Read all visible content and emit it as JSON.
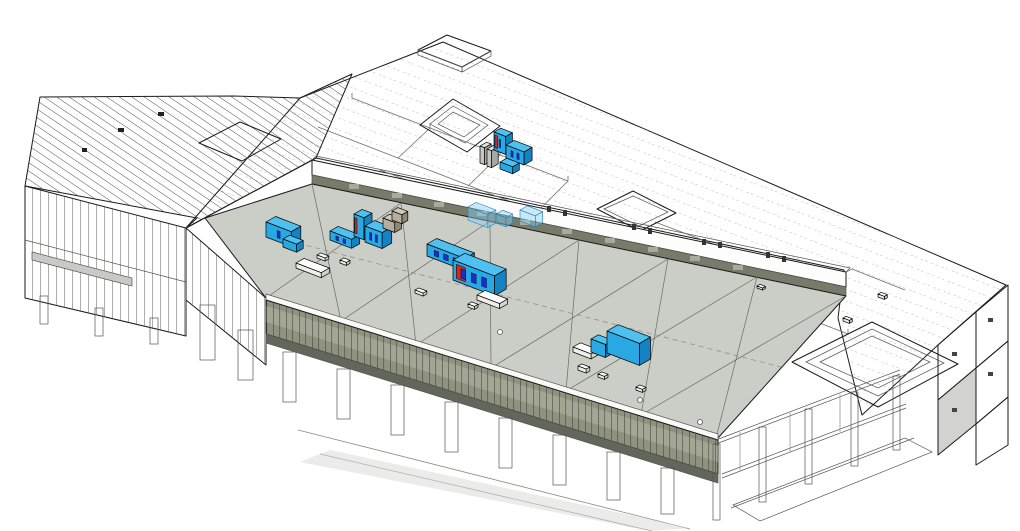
{
  "scene": {
    "name": "building-3d-axonometric-model",
    "view": "axonometric",
    "background": "#ffffff"
  },
  "colors": {
    "background": "#ffffff",
    "outline": "#1a1a1a",
    "roof_white": "#ffffff",
    "roof_gray": "#cbcdc7",
    "roof_lines": "#6a6a64",
    "hatch_line": "#3c3c38",
    "dash_line": "#9a9a96",
    "partition_line": "#6f6f6a",
    "stud_line": "#4a4a46",
    "mullion_line": "#3c3e35",
    "band_white": "#fdfdfc",
    "band_olive": "#787b6a",
    "facade_cap": "#fafaf8",
    "facade_olive": "#8f927f",
    "facade_light": "#b4b7a6",
    "facade_dark": "#63665a",
    "slab_gray": "#c9c9c5",
    "panel_gray": "#d2d2ce",
    "hvac_top": "#4fc1f0",
    "hvac_front": "#29a9e4",
    "hvac_side": "#1583c2",
    "hvac_dark_panel": "#1b2ec9",
    "hvac_red": "#cf2a21",
    "tan_top": "#cfc9b8",
    "tan_front": "#b5ae9c",
    "tan_side": "#8f8877",
    "curb_top": "#ffffff",
    "curb_front": "#efefea",
    "curb_side": "#d5d5cf",
    "ghost_blue": "#85cef2",
    "ghost_stroke": "#1d7fb5"
  },
  "equipment": {
    "units": [
      {
        "kind": "panel",
        "x": 480,
        "y": 163,
        "w": 5,
        "d": 9,
        "h": 17
      },
      {
        "kind": "panel",
        "x": 487,
        "y": 166,
        "w": 5,
        "d": 9,
        "h": 17
      },
      {
        "kind": "ahu",
        "x": 494,
        "y": 150,
        "w": 13,
        "d": 9,
        "h": 18,
        "accent": "red",
        "panels": 1
      },
      {
        "kind": "ahu",
        "x": 506,
        "y": 158,
        "w": 20,
        "d": 11,
        "h": 13,
        "panels": 2
      },
      {
        "kind": "ahu",
        "x": 500,
        "y": 169,
        "w": 14,
        "d": 9,
        "h": 7
      },
      {
        "kind": "ghost",
        "x": 468,
        "y": 220,
        "w": 22,
        "d": 11,
        "h": 13
      },
      {
        "kind": "ghost",
        "x": 496,
        "y": 223,
        "w": 11,
        "d": 9,
        "h": 9
      },
      {
        "kind": "ghost",
        "x": 520,
        "y": 221,
        "w": 17,
        "d": 10,
        "h": 11
      },
      {
        "kind": "ahu",
        "x": 266,
        "y": 237,
        "w": 28,
        "d": 13,
        "h": 15,
        "panels": 1
      },
      {
        "kind": "ahu",
        "x": 283,
        "y": 247,
        "w": 15,
        "d": 9,
        "h": 8
      },
      {
        "kind": "curb",
        "x": 296,
        "y": 268,
        "w": 28,
        "d": 11,
        "h": 5
      },
      {
        "kind": "ahu",
        "x": 330,
        "y": 240,
        "w": 24,
        "d": 11,
        "h": 9,
        "panels": 2
      },
      {
        "kind": "ahu",
        "x": 354,
        "y": 236,
        "w": 11,
        "d": 11,
        "h": 22,
        "accent": "red"
      },
      {
        "kind": "ahu",
        "x": 365,
        "y": 242,
        "w": 19,
        "d": 13,
        "h": 16,
        "panels": 2
      },
      {
        "kind": "tan",
        "x": 383,
        "y": 228,
        "w": 13,
        "d": 9,
        "h": 10
      },
      {
        "kind": "tan",
        "x": 392,
        "y": 220,
        "w": 11,
        "d": 8,
        "h": 9
      },
      {
        "kind": "ahu",
        "x": 427,
        "y": 256,
        "w": 42,
        "d": 13,
        "h": 12,
        "panels": 3
      },
      {
        "kind": "ahu",
        "x": 453,
        "y": 280,
        "w": 46,
        "d": 16,
        "h": 20,
        "panels": 3,
        "accent": "red"
      },
      {
        "kind": "curb",
        "x": 477,
        "y": 300,
        "w": 25,
        "d": 11,
        "h": 5
      },
      {
        "kind": "curb",
        "x": 573,
        "y": 352,
        "w": 20,
        "d": 10,
        "h": 5
      },
      {
        "kind": "ahu",
        "x": 591,
        "y": 352,
        "w": 16,
        "d": 10,
        "h": 13
      },
      {
        "kind": "ahu",
        "x": 607,
        "y": 353,
        "w": 36,
        "d": 15,
        "h": 22
      },
      {
        "kind": "vent",
        "x": 317,
        "y": 258,
        "w": 9,
        "d": 5,
        "h": 3
      },
      {
        "kind": "vent",
        "x": 340,
        "y": 263,
        "w": 7,
        "d": 5,
        "h": 3
      },
      {
        "kind": "vent",
        "x": 415,
        "y": 293,
        "w": 9,
        "d": 5,
        "h": 3
      },
      {
        "kind": "vent",
        "x": 468,
        "y": 307,
        "w": 7,
        "d": 5,
        "h": 3
      },
      {
        "kind": "vent",
        "x": 578,
        "y": 370,
        "w": 9,
        "d": 5,
        "h": 4
      },
      {
        "kind": "vent",
        "x": 598,
        "y": 377,
        "w": 7,
        "d": 5,
        "h": 3
      },
      {
        "kind": "vent",
        "x": 636,
        "y": 390,
        "w": 7,
        "d": 5,
        "h": 3
      },
      {
        "kind": "vent",
        "x": 878,
        "y": 297,
        "w": 7,
        "d": 4,
        "h": 3
      },
      {
        "kind": "vent",
        "x": 843,
        "y": 321,
        "w": 7,
        "d": 4,
        "h": 3
      },
      {
        "kind": "vent",
        "x": 757,
        "y": 288,
        "w": 6,
        "d": 4,
        "h": 2
      }
    ]
  }
}
